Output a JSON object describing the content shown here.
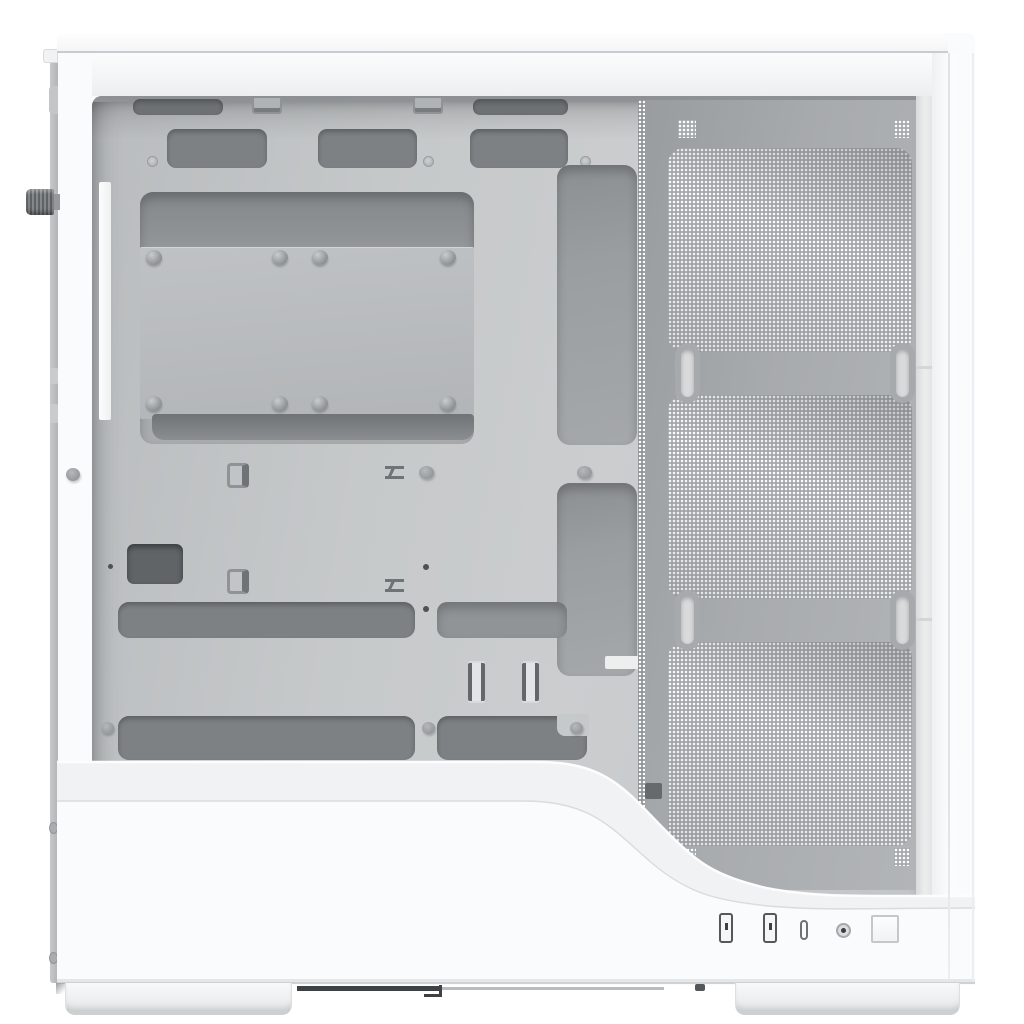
{
  "scene": {
    "subject": "white PC tower case, right-side profile with side panel removed",
    "content": "motherboard tray cable side, triple-fan perforated mesh side intake, front I/O on bottom edge, two case feet",
    "background": "#ffffff"
  },
  "colors": {
    "bg": "#ffffff",
    "body": "#fafbfc",
    "slab_top": "#fefefe",
    "slab_bot": "#f4f5f6",
    "hairline": "#c9cbcd",
    "band": "#f3f4f5",
    "rear_a": "#c6c8ca",
    "rear_b": "#b2b5b7",
    "knob_dark": "#5f6365",
    "knob_lite": "#84888b",
    "tray_a": "#b9bcbe",
    "tray_b": "#c6c9ca",
    "tray_c": "#cbcdcf",
    "cutout": "#7d8183",
    "cutout_deep": "#6d7173",
    "recess_a": "#8b8f91",
    "recess_b": "#a5a8aa",
    "plate_a": "#bfc2c4",
    "plate_b": "#b2b5b7",
    "rivet_hi": "#c9ccce",
    "rivet_lo": "#8d9193",
    "peg_lo": "#94989a",
    "dot_dark": "#4f5254",
    "mesh_frame_a": "#989c9f",
    "mesh_frame_b": "#b2b5b7",
    "mesh_bg": "#a4a8ab",
    "mesh_dot": "#fbfcfc",
    "channel_a": "#d8dadb",
    "channel_b": "#eceeee",
    "seam": "#d3d5d6",
    "port_frame": "#54585a",
    "port_fill": "#f5f6f6",
    "port_pin": "#3d4042",
    "jack_ring": "#a6a9ab",
    "jack_fill": "#e3e4e5",
    "jack_hole": "#3b3e40",
    "button_edge": "#c5c7c9",
    "foot_a": "#f8f9f9",
    "foot_b": "#e6e8e9",
    "under_dark": "#3f4244"
  },
  "case": {
    "rear_edge": {
      "thumbscrew_knobs": 1,
      "edge_screws": 2
    },
    "motherboard_tray": {
      "rivets": 8,
      "screw_dimples": 3,
      "top_cutouts": 2,
      "upper_cutouts": 3,
      "long_cable_cutouts": 4,
      "square_cutout": 1,
      "cable_clips": 4,
      "tie_down_slot_pairs": 2,
      "standoff_pegs": 5
    },
    "side_mesh": {
      "fan_positions": 3,
      "corner_vent_tabs": 4,
      "mounting_slots": 4
    },
    "front_io": {
      "ports": [
        {
          "id": "usb-a-1",
          "type": "usb-a"
        },
        {
          "id": "usb-a-2",
          "type": "usb-a"
        },
        {
          "id": "usb-c-1",
          "type": "usb-c"
        },
        {
          "id": "audio-1",
          "type": "headphone-jack"
        }
      ],
      "power_button": "square"
    },
    "feet": 2
  }
}
